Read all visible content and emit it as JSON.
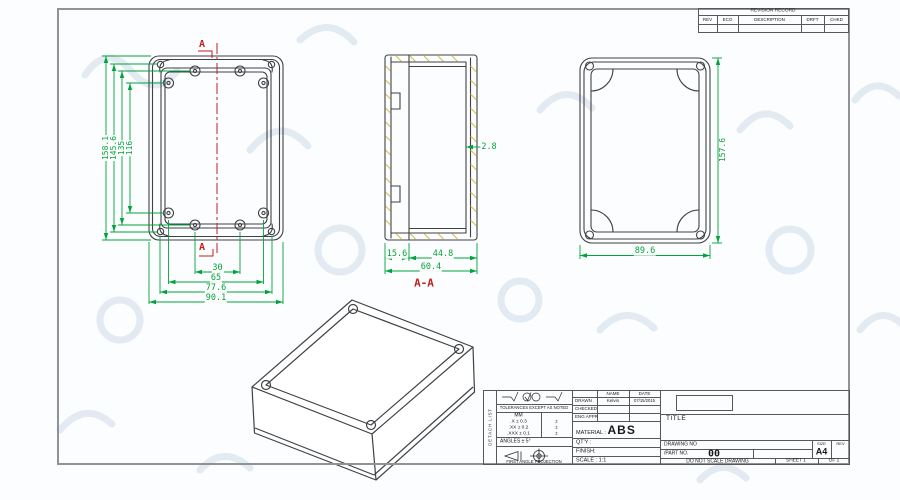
{
  "revision_table": {
    "title": "REVISION RECORD",
    "headers": [
      "REV",
      "ECO",
      "DESCRIPTION",
      "DRFT",
      "CHKD"
    ]
  },
  "front_view": {
    "section_label": "A",
    "dims_vertical": [
      "158.1",
      "145.6",
      "135",
      "116"
    ],
    "dims_horizontal": [
      "30",
      "65",
      "77.6",
      "90.1"
    ]
  },
  "section_view": {
    "label": "A-A",
    "wall_thickness": "2.8",
    "dims_bottom": [
      "15.6",
      "44.8",
      "60.4"
    ]
  },
  "back_view": {
    "dim_height": "157.6",
    "dim_width": "89.6"
  },
  "title_block": {
    "side_note": "DETACH LIST",
    "tolerances_header": "TOLERANCES EXCEPT AS NOTED",
    "unit": "MM",
    "tol_rows": [
      ".X ± 0.3",
      ".XX ± 0.2",
      ".XXX ± 0.1"
    ],
    "tol_marks": [
      "±",
      "±",
      "±"
    ],
    "angles": "ANGLES ± 5°",
    "projection": "FIRST ANGLE PROJECTION",
    "name_header": "NAME",
    "date_header": "DATE",
    "drawn_label": "DRAWN",
    "drawn_name": "Kelvin",
    "drawn_date": "07/15/2015",
    "checked_label": "CHECKED",
    "eng_appr_label": "ENG APPR",
    "material_label": "MATERIAL :",
    "material_value": "ABS",
    "qty_label": "QT'Y :",
    "finish_label": "FINISH:",
    "scale_label": "SCALE : 1:1",
    "title_label": "TITLE",
    "drawing_no_label": "DRAWING NO",
    "part_no_label": "/PART  NO.",
    "part_no_value": "00",
    "do_not_scale": "DO NOT SCALE DRAWING",
    "size_label": "SIZE",
    "size_value": "A4",
    "rev_label": "REV",
    "sheet_label": "SHEET 1",
    "of_label": "OF 1"
  }
}
